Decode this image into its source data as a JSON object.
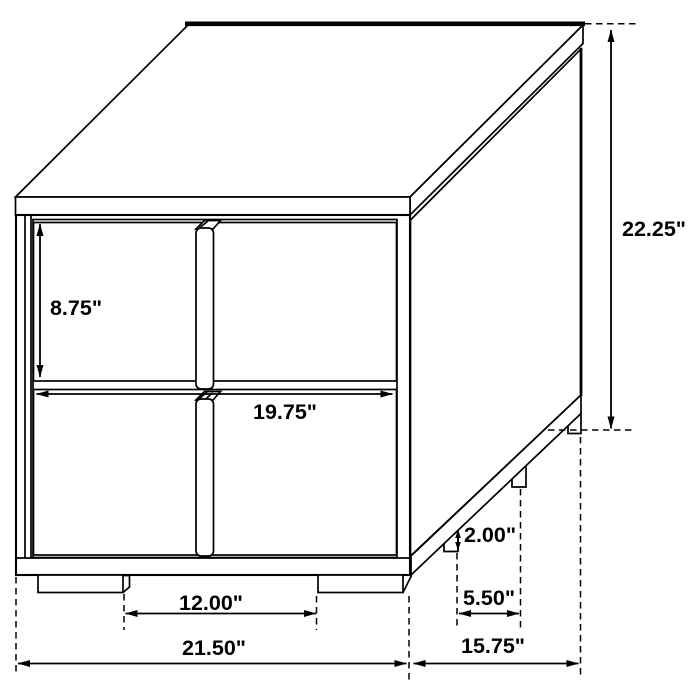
{
  "diagram": {
    "title": "two-drawer nightstand dimension drawing",
    "units": "inches",
    "line_color": "#000000",
    "background_color": "#ffffff",
    "labels": {
      "drawer_height": "8.75\"",
      "overall_height": "22.25\"",
      "interior_width": "19.75\"",
      "foot_height": "2.00\"",
      "side_foot_spacing": "5.50\"",
      "front_foot_spacing": "12.00\"",
      "overall_width": "21.50\"",
      "overall_depth": "15.75\""
    }
  }
}
